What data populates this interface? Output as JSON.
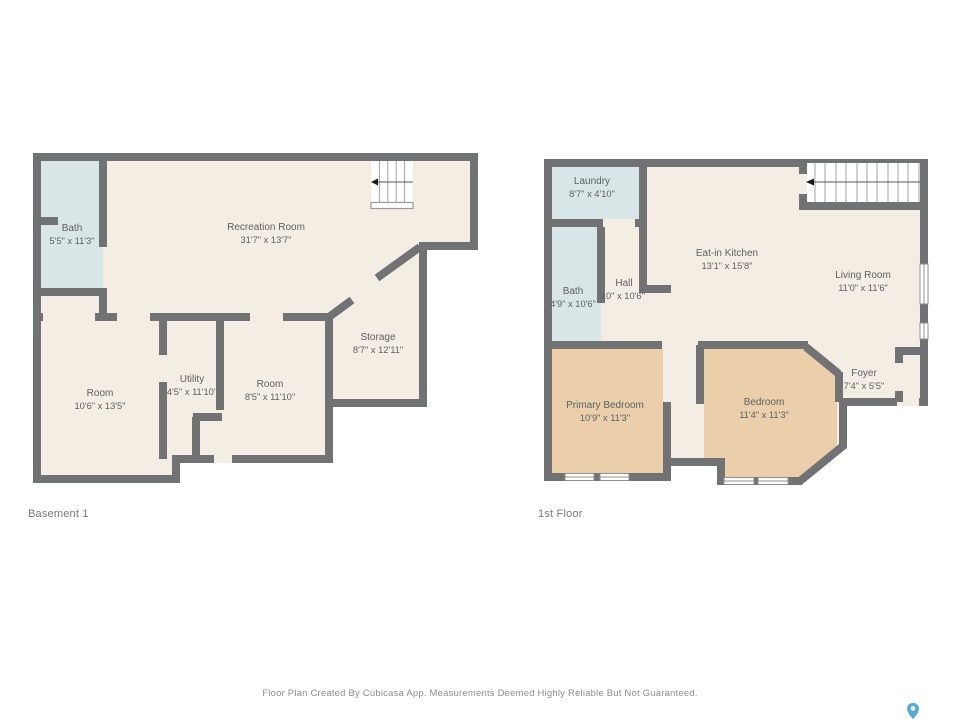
{
  "colors": {
    "wall": "#717274",
    "floor": "#f4ede3",
    "wet_room": "#d9e6e8",
    "bedroom": "#ebcfab",
    "label_text": "#5c6166",
    "pin_blue": "#55a9d9"
  },
  "plans": [
    {
      "name": "Basement 1",
      "rooms": [
        {
          "label": "Bath",
          "dims": "5'5\" x 11'3\""
        },
        {
          "label": "Recreation Room",
          "dims": "31'7\" x 13'7\""
        },
        {
          "label": "Storage",
          "dims": "8'7\" x 12'11\""
        },
        {
          "label": "Room",
          "dims": "10'6\" x 13'5\""
        },
        {
          "label": "Utility",
          "dims": "4'5\" x 11'10\""
        },
        {
          "label": "Room",
          "dims": "8'5\" x 11'10\""
        }
      ]
    },
    {
      "name": "1st Floor",
      "rooms": [
        {
          "label": "Laundry",
          "dims": "8'7\" x 4'10\""
        },
        {
          "label": "Bath",
          "dims": "4'9\" x 10'6\""
        },
        {
          "label": "Hall",
          "dims": "'10\" x 10'6\""
        },
        {
          "label": "Eat-in Kitchen",
          "dims": "13'1\" x 15'8\""
        },
        {
          "label": "Living Room",
          "dims": "11'0\" x 11'6\""
        },
        {
          "label": "Foyer",
          "dims": "7'4\" x 5'5\""
        },
        {
          "label": "Primary Bedroom",
          "dims": "10'9\" x 11'3\""
        },
        {
          "label": "Bedroom",
          "dims": "11'4\" x 11'3\""
        }
      ]
    }
  ],
  "footer": {
    "disclaimer": "Floor Plan Created By Cubicasa App. Measurements Deemed Highly Reliable But Not Guaranteed."
  }
}
